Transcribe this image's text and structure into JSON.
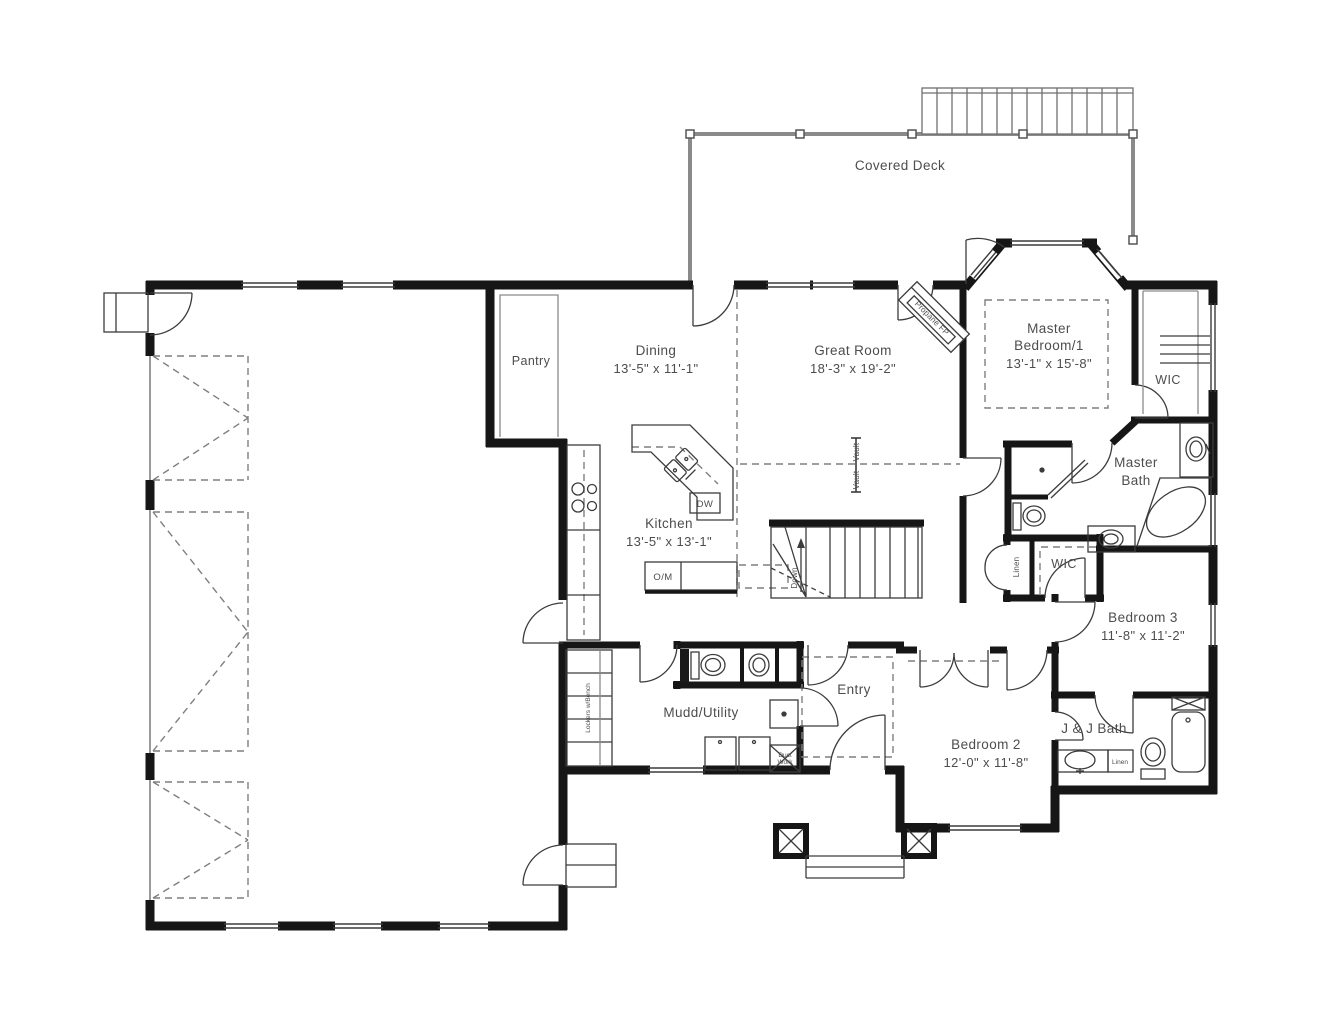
{
  "title": "First Floor Plan",
  "colors": {
    "wall": "#161616",
    "line": "#3c3c3c",
    "muted": "#8a8a8a",
    "text": "#4d4d4d",
    "background": "#ffffff"
  },
  "deck": {
    "label": "Covered Deck"
  },
  "rooms": [
    {
      "id": "dining",
      "name": "Dining",
      "dims": "13'-5\" x 11'-1\""
    },
    {
      "id": "great",
      "name": "Great Room",
      "dims": "18'-3\" x 19'-2\""
    },
    {
      "id": "kitchen",
      "name": "Kitchen",
      "dims": "13'-5\" x 13'-1\""
    },
    {
      "id": "master",
      "name1": "Master",
      "name2": "Bedroom/1",
      "dims": "13'-1\" x 15'-8\""
    },
    {
      "id": "bedroom2",
      "name": "Bedroom 2",
      "dims": "12'-0\" x 11'-8\""
    },
    {
      "id": "bedroom3",
      "name": "Bedroom 3",
      "dims": "11'-8\" x 11'-2\""
    }
  ],
  "areas": {
    "pantry": "Pantry",
    "entry": "Entry",
    "mudd_utility": "Mudd/Utility",
    "master_bath_1": "Master",
    "master_bath_2": "Bath",
    "jj_bath": "J & J Bath",
    "wic_master": "WIC",
    "wic_hall": "WIC"
  },
  "annotations": {
    "linen_hall": "Linen",
    "linen_jj": "Linen",
    "lockers": "Lockers w/Bench",
    "om": "O/M",
    "dw": "DW",
    "propane_fp": "Propane FP",
    "vault": "Vault",
    "down": "Down",
    "duct_1": "Duct",
    "duct_2": "Work"
  }
}
